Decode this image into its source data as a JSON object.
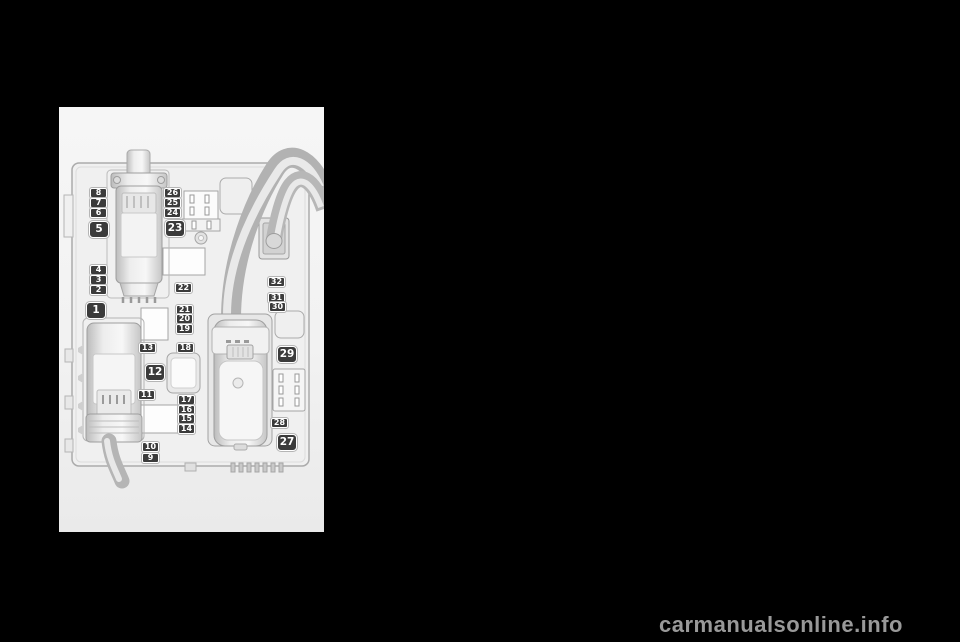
{
  "page": {
    "background_color": "#000000",
    "watermark": "carmanualsonline.info",
    "watermark_color": "#999999"
  },
  "diagram": {
    "name": "engine-compartment-fuse-box",
    "label_style": {
      "background": "#3b3b3b",
      "text_color": "#ffffff",
      "border_color": "#ffffff"
    },
    "fuse_labels": [
      {
        "label": "8",
        "x": 31,
        "y": 81,
        "size": "small"
      },
      {
        "label": "7",
        "x": 31,
        "y": 91,
        "size": "small"
      },
      {
        "label": "6",
        "x": 31,
        "y": 101,
        "size": "small"
      },
      {
        "label": "5",
        "x": 30,
        "y": 114,
        "size": "large"
      },
      {
        "label": "4",
        "x": 31,
        "y": 158,
        "size": "small"
      },
      {
        "label": "3",
        "x": 31,
        "y": 168,
        "size": "small"
      },
      {
        "label": "2",
        "x": 31,
        "y": 178,
        "size": "small"
      },
      {
        "label": "1",
        "x": 27,
        "y": 195,
        "size": "large"
      },
      {
        "label": "26",
        "x": 105,
        "y": 81,
        "size": "small"
      },
      {
        "label": "25",
        "x": 105,
        "y": 91,
        "size": "small"
      },
      {
        "label": "24",
        "x": 105,
        "y": 101,
        "size": "small"
      },
      {
        "label": "23",
        "x": 106,
        "y": 113,
        "size": "large"
      },
      {
        "label": "22",
        "x": 116,
        "y": 176,
        "size": "small"
      },
      {
        "label": "21",
        "x": 117,
        "y": 198,
        "size": "small"
      },
      {
        "label": "20",
        "x": 117,
        "y": 207,
        "size": "small"
      },
      {
        "label": "19",
        "x": 117,
        "y": 217,
        "size": "small"
      },
      {
        "label": "18",
        "x": 118,
        "y": 236,
        "size": "small"
      },
      {
        "label": "13",
        "x": 80,
        "y": 236,
        "size": "small"
      },
      {
        "label": "12",
        "x": 86,
        "y": 257,
        "size": "large"
      },
      {
        "label": "11",
        "x": 79,
        "y": 283,
        "size": "small"
      },
      {
        "label": "17",
        "x": 119,
        "y": 288,
        "size": "small"
      },
      {
        "label": "16",
        "x": 119,
        "y": 298,
        "size": "small"
      },
      {
        "label": "15",
        "x": 119,
        "y": 307,
        "size": "small"
      },
      {
        "label": "14",
        "x": 119,
        "y": 317,
        "size": "small"
      },
      {
        "label": "10",
        "x": 83,
        "y": 335,
        "size": "small"
      },
      {
        "label": "9",
        "x": 83,
        "y": 346,
        "size": "small"
      },
      {
        "label": "32",
        "x": 209,
        "y": 170,
        "size": "small"
      },
      {
        "label": "31",
        "x": 209,
        "y": 186,
        "size": "small"
      },
      {
        "label": "30",
        "x": 210,
        "y": 195,
        "size": "small"
      },
      {
        "label": "29",
        "x": 218,
        "y": 239,
        "size": "large"
      },
      {
        "label": "28",
        "x": 212,
        "y": 311,
        "size": "small"
      },
      {
        "label": "27",
        "x": 218,
        "y": 327,
        "size": "large"
      }
    ]
  }
}
